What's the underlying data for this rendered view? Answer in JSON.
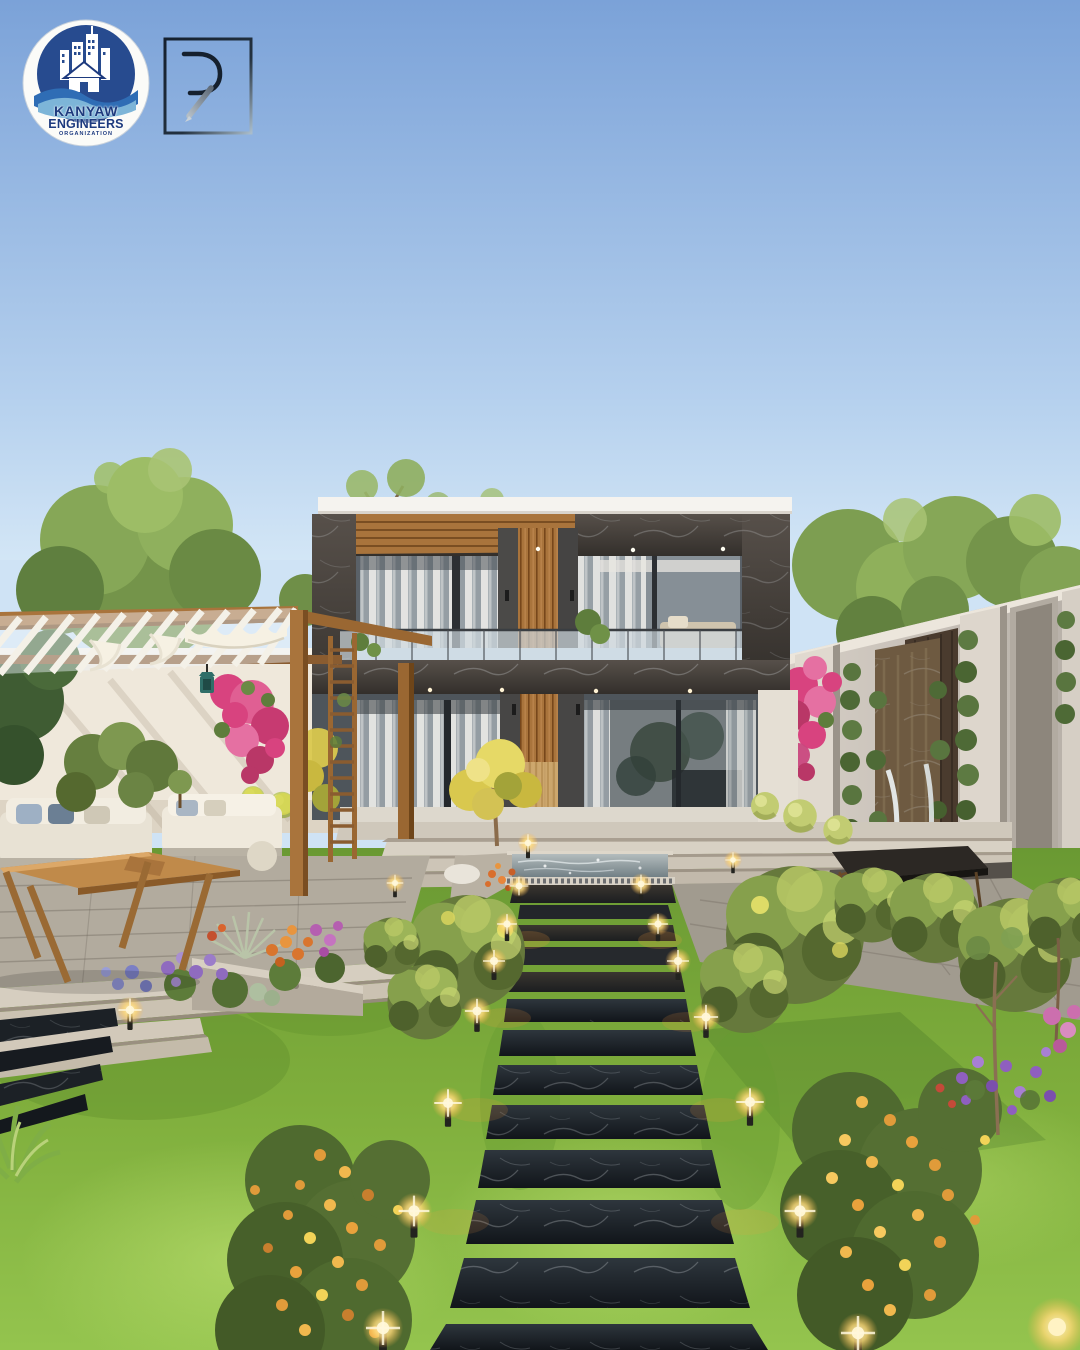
{
  "branding": {
    "badge_line1": "KANYAW",
    "badge_line2": "ENGINEERS",
    "badge_line3": "ORGANIZATION",
    "monogram_letter": "R"
  },
  "palette": {
    "sky_top": "#7ba2d8",
    "sky_bottom": "#d3e6f6",
    "house_marble": "#45403a",
    "house_wood": "#a9743c",
    "roof_white": "#f5f3ef",
    "pergola_wood": "#a9743c",
    "canopy_white": "#f3efe5",
    "wall_light": "#eee7da",
    "lawn_green": "#7fae3c",
    "path_marble_black": "#14181d",
    "pool_water": "#8b989e",
    "bougainvillea_pink": "#d8437f",
    "flower_orange": "#e8a23c",
    "flower_purple": "#8f6bbf",
    "bollard_glow": "#ffd978",
    "badge_navy": "#274b8f",
    "badge_wave_blue": "#7db5d8"
  }
}
